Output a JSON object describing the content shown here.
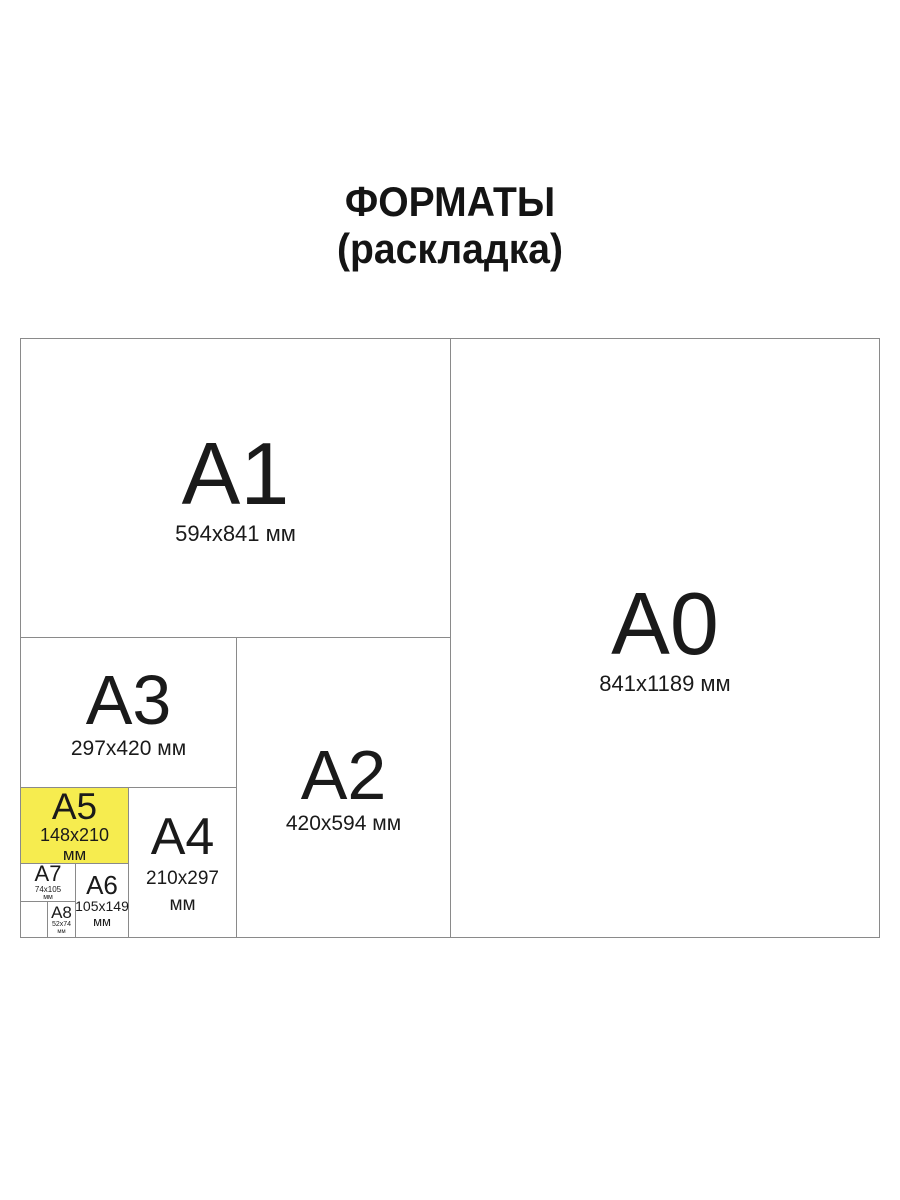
{
  "title": {
    "line1": "ФОРМАТЫ",
    "line2": "(раскладка)"
  },
  "colors": {
    "background": "#ffffff",
    "line": "#8a8a8a",
    "text": "#1a1a1a",
    "highlight_fill": "#f6ec4f"
  },
  "highlighted_format": "A5",
  "formats": {
    "a0": {
      "label": "A0",
      "dims": "841x1189 мм"
    },
    "a1": {
      "label": "A1",
      "dims": "594x841 мм"
    },
    "a2": {
      "label": "A2",
      "dims": "420x594 мм"
    },
    "a3": {
      "label": "A3",
      "dims": "297x420 мм"
    },
    "a4": {
      "label": "A4",
      "dims": "210x297",
      "unit": "мм"
    },
    "a5": {
      "label": "A5",
      "dims": "148x210",
      "unit": "мм"
    },
    "a6": {
      "label": "A6",
      "dims": "105x149",
      "unit": "мм"
    },
    "a7": {
      "label": "A7",
      "dims": "74x105",
      "unit": "мм"
    },
    "a8": {
      "label": "A8",
      "dims": "52x74",
      "unit": "мм"
    }
  }
}
